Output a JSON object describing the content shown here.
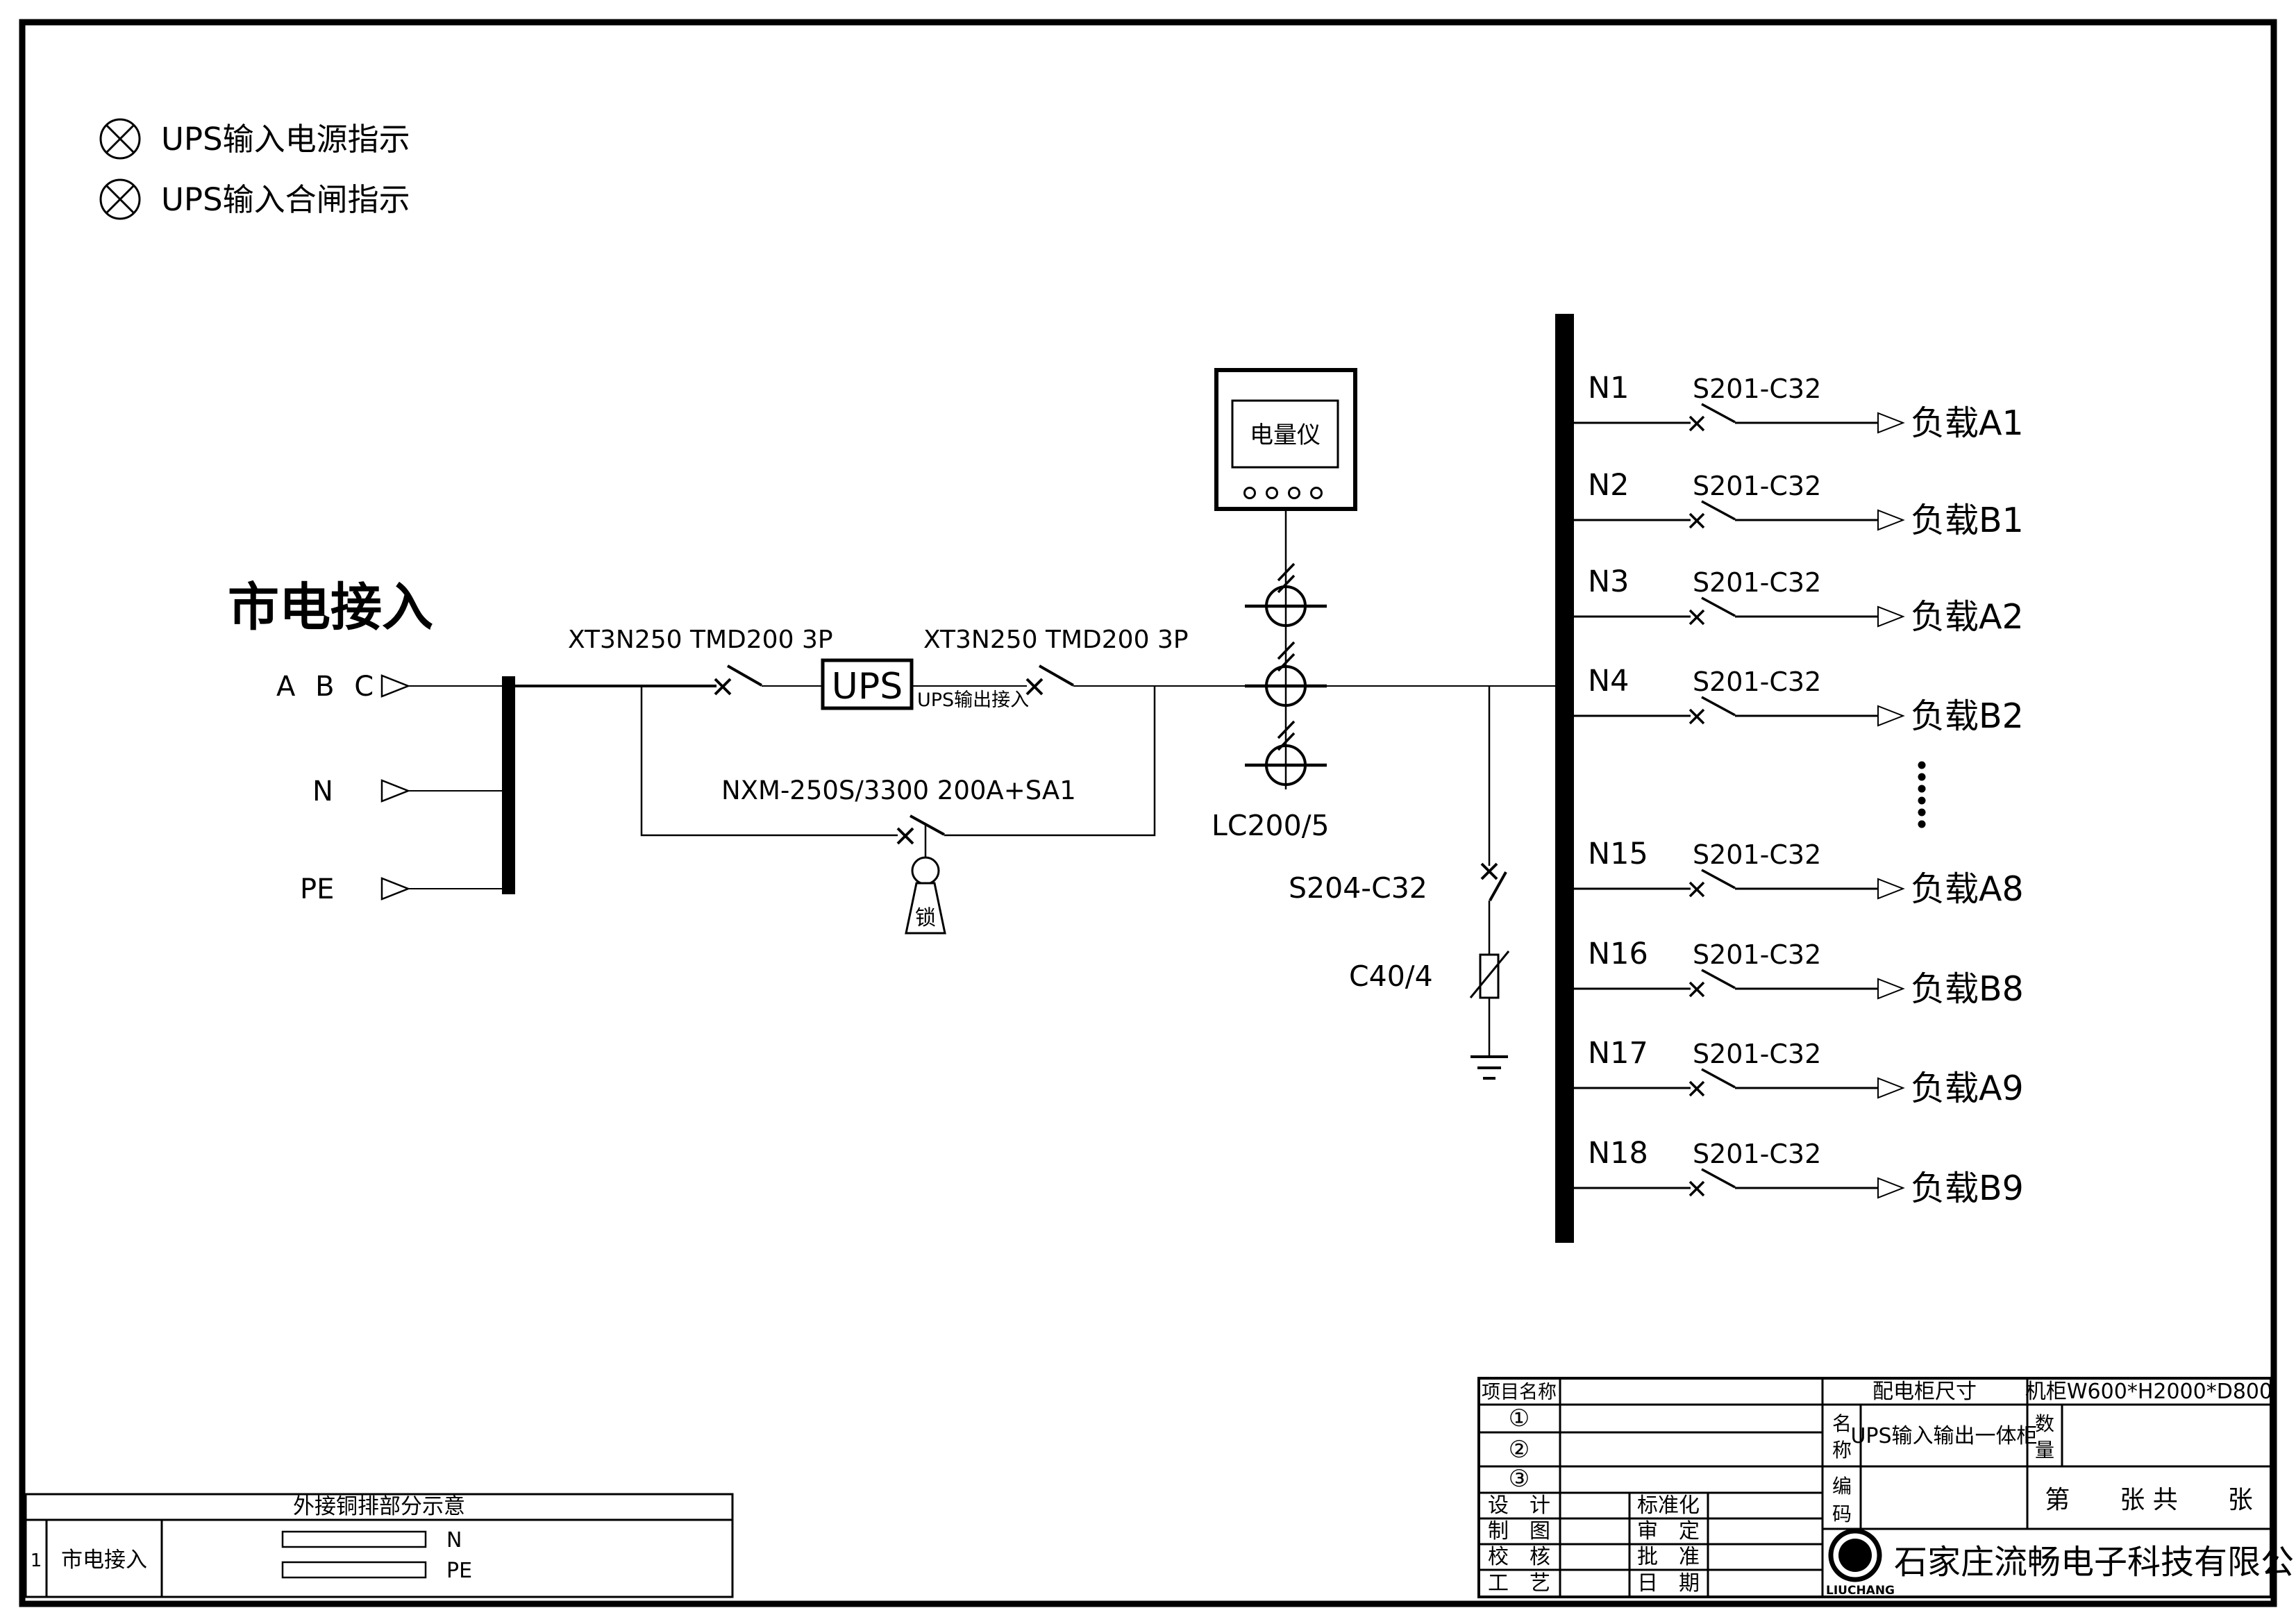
{
  "drawing": {
    "indicators": [
      {
        "label": "UPS输入电源指示"
      },
      {
        "label": "UPS输入合闸指示"
      }
    ],
    "mains": {
      "title": "市电接入",
      "phase": "A B C",
      "neutral": "N",
      "pe": "PE"
    },
    "input_breaker_label": "XT3N250 TMD200 3P",
    "output_breaker_label": "XT3N250 TMD200 3P",
    "ups": {
      "box_label": "UPS",
      "output_note": "UPS输出接入"
    },
    "bypass_breaker_label": "NXM-250S/3300 200A+SA1",
    "lock_label": "锁",
    "meter_label": "电量仪",
    "ct_label": "LC200/5",
    "spd_breaker_label": "S204-C32",
    "spd_label": "C40/4",
    "branches": [
      {
        "id": "N1",
        "breaker": "S201-C32",
        "load": "负载A1"
      },
      {
        "id": "N2",
        "breaker": "S201-C32",
        "load": "负载B1"
      },
      {
        "id": "N3",
        "breaker": "S201-C32",
        "load": "负载A2"
      },
      {
        "id": "N4",
        "breaker": "S201-C32",
        "load": "负载B2"
      },
      {
        "id": "N15",
        "breaker": "S201-C32",
        "load": "负载A8"
      },
      {
        "id": "N16",
        "breaker": "S201-C32",
        "load": "负载B8"
      },
      {
        "id": "N17",
        "breaker": "S201-C32",
        "load": "负载A9"
      },
      {
        "id": "N18",
        "breaker": "S201-C32",
        "load": "负载B9"
      }
    ]
  },
  "copper_table": {
    "title": "外接铜排部分示意",
    "row_no": "1",
    "row_label": "市电接入",
    "bars": [
      {
        "label": "N"
      },
      {
        "label": "PE"
      }
    ]
  },
  "title_block": {
    "project_label": "项目名称",
    "item_rows": [
      "①",
      "②",
      "③"
    ],
    "size_label": "配电柜尺寸",
    "size_value": "机柜W600*H2000*D800",
    "name_label_chars": [
      "名",
      "称"
    ],
    "name_value": "UPS输入输出一体柜",
    "qty_label_chars": [
      "数",
      "量"
    ],
    "code_label_chars": [
      "编",
      "码"
    ],
    "sheet_text": "第　　张 共　　张",
    "sign_rows": [
      [
        "设　计",
        "标准化"
      ],
      [
        "制　图",
        "审　定"
      ],
      [
        "校　核",
        "批　准"
      ],
      [
        "工　艺",
        "日　期"
      ]
    ],
    "logo": {
      "letter": "G",
      "text": "LIUCHANG"
    },
    "company": "石家庄流畅电子科技有限公司"
  }
}
